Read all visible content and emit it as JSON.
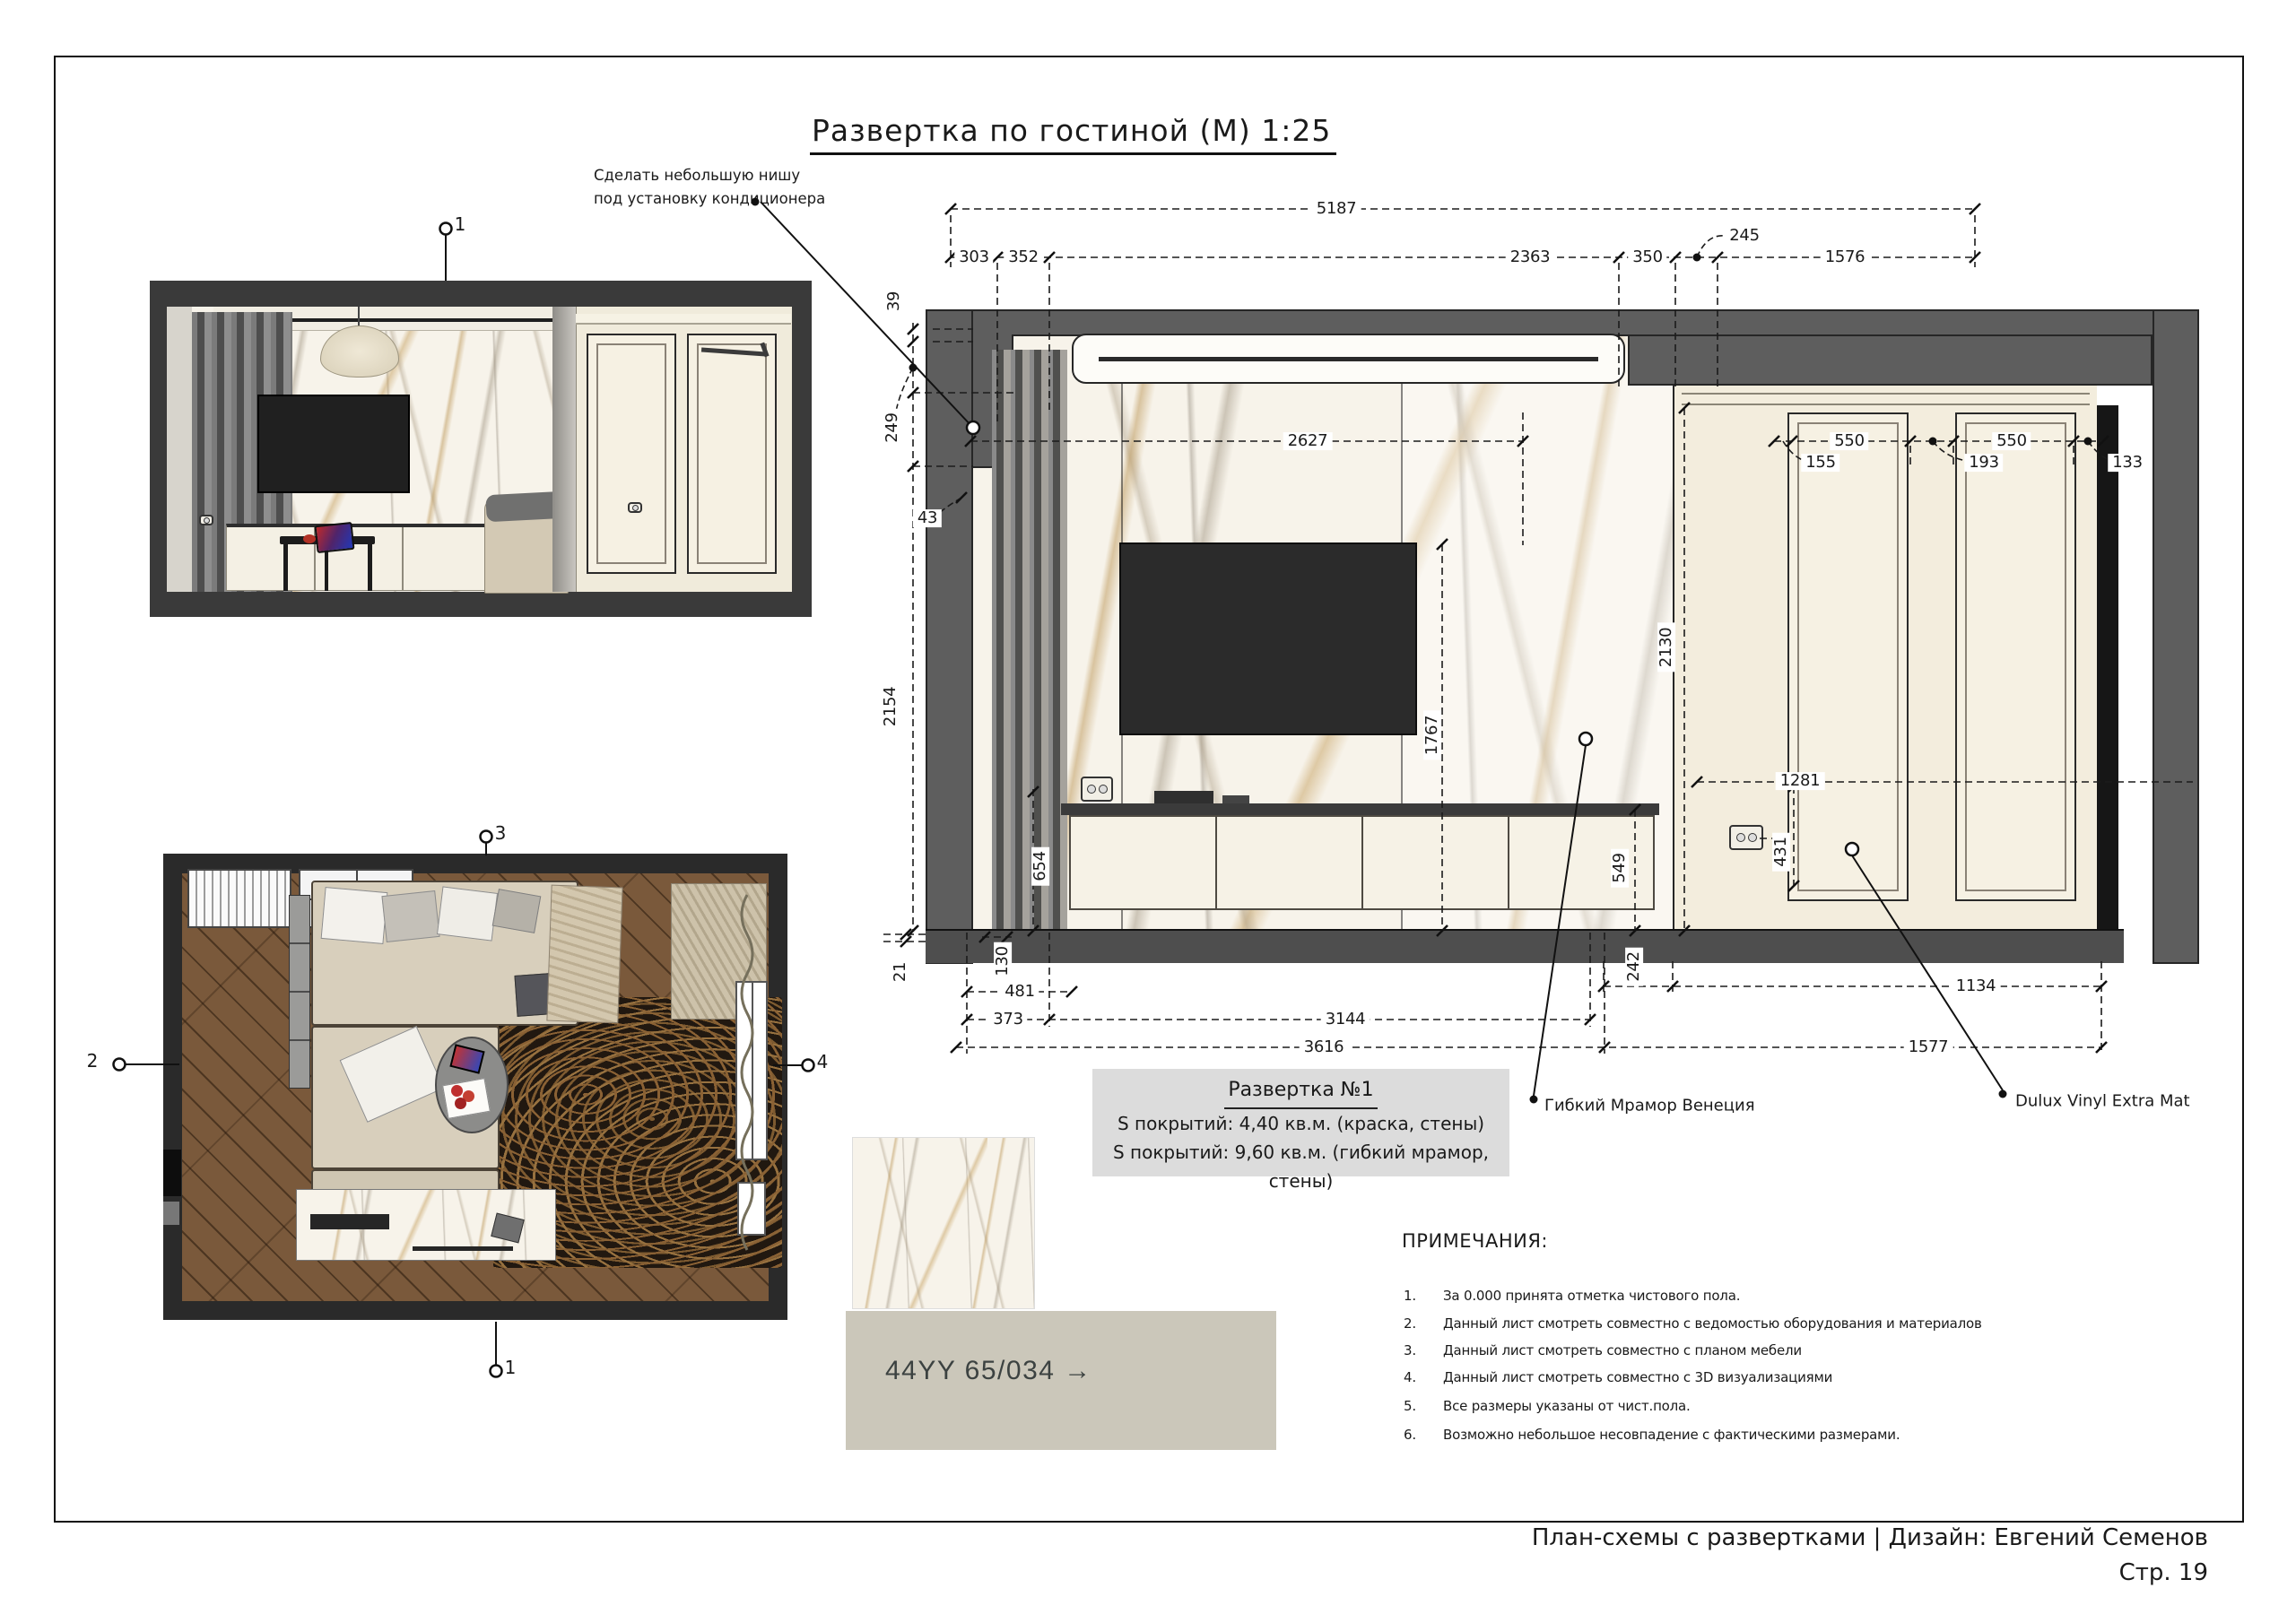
{
  "sheet": {
    "title": "Развертка по гостиной (М) 1:25",
    "footer_line1": "План-схемы с развертками | Дизайн: Евгений Семенов",
    "footer_line2": "Стр. 19"
  },
  "annotation": {
    "line1": "Сделать небольшую нишу",
    "line2": "под установку кондиционера"
  },
  "markers": {
    "render_top": "1",
    "plan_top": "3",
    "plan_left": "2",
    "plan_right": "4",
    "plan_bottom": "1"
  },
  "elevation_info": {
    "title": "Развертка №1",
    "line1": "S покрытий: 4,40 кв.м. (краска, стены)",
    "line2": "S покрытий: 9,60 кв.м. (гибкий мрамор, стены)"
  },
  "callouts": {
    "marble": "Гибкий Мрамор Венеция",
    "paint": "Dulux Vinyl Extra Mat"
  },
  "materials": {
    "paint_code": "44YY 65/034 →"
  },
  "dimensions": {
    "d5187": "5187",
    "d303": "303",
    "d352": "352",
    "d2363": "2363",
    "d350": "350",
    "d245": "245",
    "d1576": "1576",
    "d39": "39",
    "d249": "249",
    "d43": "43",
    "d2154": "2154",
    "d654": "654",
    "d21": "21",
    "d130": "130",
    "d481": "481",
    "d373": "373",
    "d3144": "3144",
    "d3616": "3616",
    "d242": "242",
    "d1134": "1134",
    "d1577": "1577",
    "d2627": "2627",
    "d1767": "1767",
    "d549": "549",
    "d2130": "2130",
    "d1281": "1281",
    "d431": "431",
    "d550a": "550",
    "d155": "155",
    "d550b": "550",
    "d193": "193",
    "d133": "133"
  },
  "notes": {
    "heading": "ПРИМЕЧАНИЯ:",
    "items": [
      {
        "n": "1.",
        "text": "За 0.000 принята отметка чистового пола."
      },
      {
        "n": "2.",
        "text": "Данный лист смотреть совместно с ведомостью оборудования и материалов"
      },
      {
        "n": "3.",
        "text": "Данный лист смотреть совместно с планом мебели"
      },
      {
        "n": "4.",
        "text": "Данный лист смотреть совместно с 3D визуализациями"
      },
      {
        "n": "5.",
        "text": "Все размеры указаны от чист.пола."
      },
      {
        "n": "6.",
        "text": "Возможно небольшое несовпадение с фактическими размерами."
      }
    ]
  }
}
